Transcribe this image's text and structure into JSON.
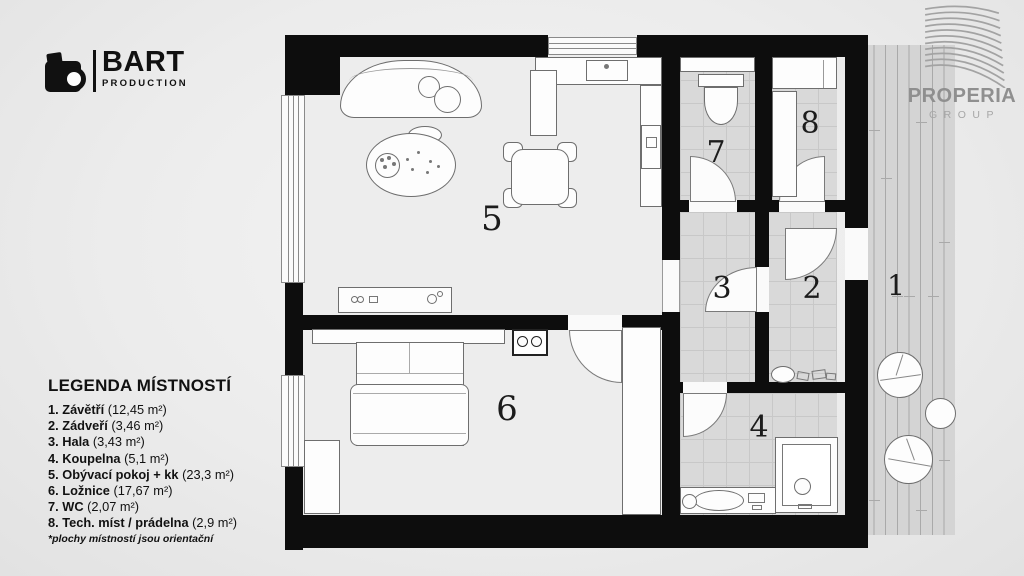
{
  "branding": {
    "bart": {
      "name": "BART",
      "sub": "PRODUCTION"
    },
    "properia": {
      "name": "PROPERIA",
      "sub": "GROUP"
    }
  },
  "legend": {
    "title": "LEGENDA MÍSTNOSTÍ",
    "items": [
      {
        "num": "1.",
        "name": "Závětří",
        "area": "(12,45 m²)"
      },
      {
        "num": "2.",
        "name": "Zádveří",
        "area": "(3,46 m²)"
      },
      {
        "num": "3.",
        "name": "Hala",
        "area": "(3,43 m²)"
      },
      {
        "num": "4.",
        "name": "Koupelna",
        "area": "(5,1 m²)"
      },
      {
        "num": "5.",
        "name": "Obývací pokoj + kk",
        "area": "(23,3 m²)"
      },
      {
        "num": "6.",
        "name": "Ložnice",
        "area": "(17,67 m²)"
      },
      {
        "num": "7.",
        "name": "WC",
        "area": "(2,07 m²)"
      },
      {
        "num": "8.",
        "name": "Tech. míst / prádelna",
        "area": "(2,9 m²)"
      }
    ],
    "footnote": "*plochy místností jsou orientační"
  },
  "plan": {
    "labels": {
      "r1": "1",
      "r2": "2",
      "r3": "3",
      "r4": "4",
      "r5": "5",
      "r6": "6",
      "r7": "7",
      "r8": "8"
    }
  },
  "colors": {
    "wall": "#0d0d0d",
    "tile": "#d9d9d9",
    "deck": "#d4d4d4",
    "logo_gray": "#a3a3a3"
  }
}
